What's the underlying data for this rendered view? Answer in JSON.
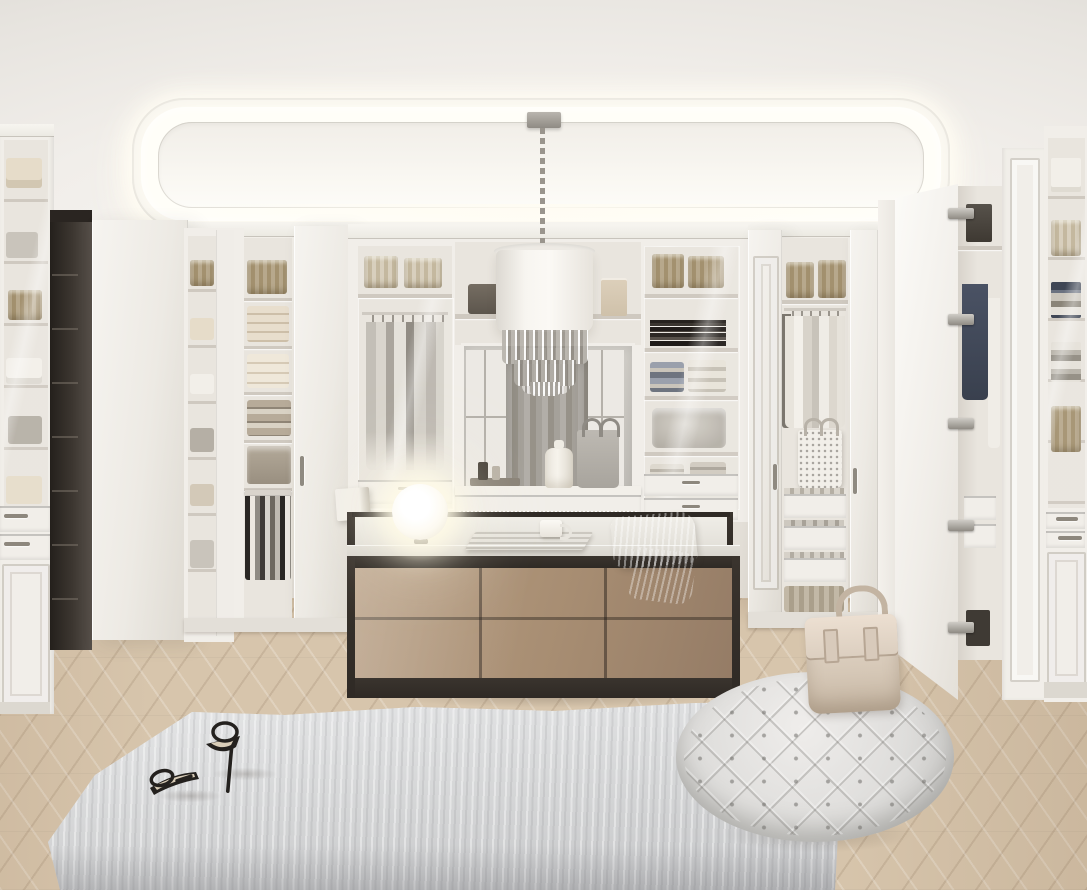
{
  "scene": {
    "title": "Luxury white walk-in closet interior",
    "description": "Photorealistic render of a symmetrical walk-in wardrobe: illuminated tray ceiling with cove lighting, crystal drum chandelier, built-in white closets with glass doors, folded linens, wicker baskets and hanging shirts, a central mirror over a vanity shelf, a taupe island dresser with a glowing sphere lamp, a shaggy gray rug with black stiletto sandals, a round tufted pouf with a cream leather handbag, and a light herringbone oak floor.",
    "objects": [
      "illuminated-tray-ceiling",
      "crystal-drum-chandelier",
      "left-glass-display-cabinet",
      "dark-framed-doorway",
      "open-white-doors",
      "corner-shelf-tower",
      "wardrobe-with-trouser-rack",
      "glass-wardrobe-hanging-clothes",
      "center-mirror",
      "vanity-shelf-with-jar-perfume-bag",
      "glass-cabinet-with-books",
      "wardrobe-with-shirts-and-tote",
      "open-door-with-hinges",
      "right-glass-cabinet-knitwear",
      "island-dresser",
      "sphere-lamp",
      "open-magazine",
      "mug",
      "gray-throw-blanket",
      "shaggy-gray-rug",
      "black-stiletto-sandals",
      "tufted-round-pouf",
      "cream-handbag",
      "herringbone-floor"
    ]
  },
  "palette": {
    "wall": "#eae7e1",
    "wall_bright": "#f4f1ec",
    "ceiling_base": "#efece7",
    "cove_white": "#fffef8",
    "cabinet_face": "#f1eee9",
    "interior": "#e9e5de",
    "shelf": "#cfc9c0",
    "wicker": "#b7a88c",
    "wicker_dark": "#a3916f",
    "basket_pale": "#d3c9b8",
    "linen_cream": "#e6dcc9",
    "linen_gray": "#b5afa5",
    "cloth_white": "#f2efe9",
    "cloth_gray": "#c9c4bb",
    "books": "#2e2a26",
    "dark_frame": "#332d28",
    "navy": "#475062",
    "mirror": "#cbc8c2",
    "curtain": "#a19d96",
    "window": "#ece9e4",
    "island_frame": "#2f2a25",
    "island_top": "#d9d6cf",
    "taupe_l": "#b79e83",
    "taupe": "#a78d72",
    "taupe_d": "#957c66",
    "lamp": "#fffdf2",
    "blanket": "#c9c7c2",
    "rug": "#d8d9da",
    "pouf": "#e3e2e0",
    "bag": "#dccfc0",
    "floor": "#d7c5ac",
    "floor_hi": "#ecdfc9",
    "floor_lo": "#c2ab8e",
    "shadow": "rgba(70,60,50,.22)"
  }
}
